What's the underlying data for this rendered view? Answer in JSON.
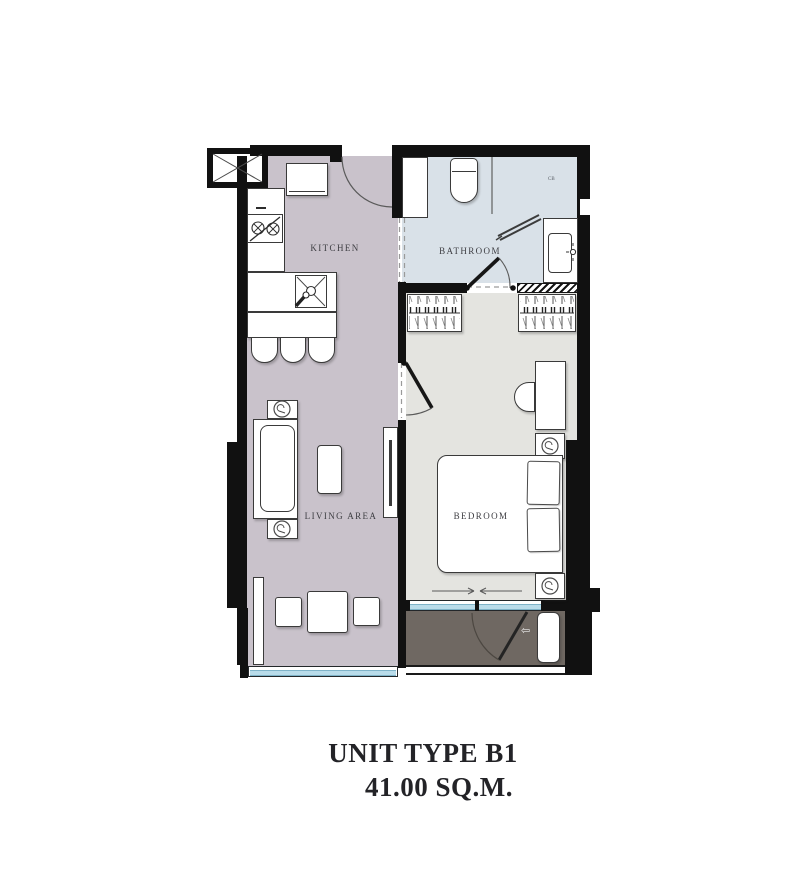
{
  "unit": {
    "title": "UNIT TYPE B1",
    "area": "41.00 SQ.M."
  },
  "rooms": {
    "kitchen": "KITCHEN",
    "bathroom": "BATHROOM",
    "bedroom": "BEDROOM",
    "living": "LIVING AREA"
  },
  "marks": {
    "cb": "CB"
  },
  "icons": {
    "balcony_door_swing": "⇦"
  },
  "colors": {
    "wall": "#111111",
    "kitchen_living_floor": "#c9c2cb",
    "bathroom_floor": "#d9e1e8",
    "bedroom_floor": "#e4e4e0",
    "balcony_floor": "#6f6862",
    "window_glass": "#b9dcea",
    "title_text": "#232327"
  }
}
